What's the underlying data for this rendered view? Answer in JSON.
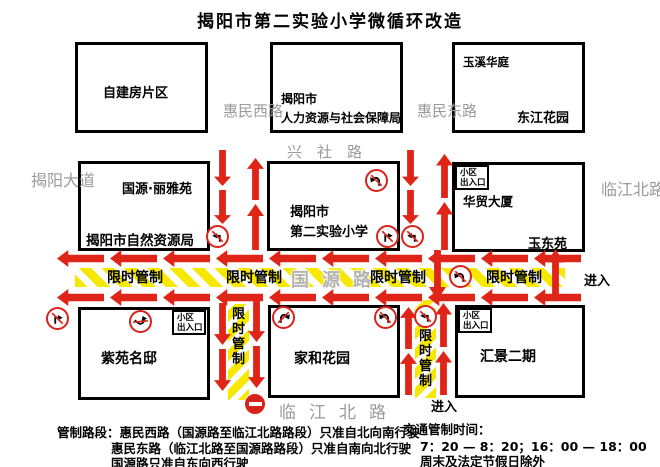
{
  "title": "揭阳市第二实验小学微循环改造",
  "buildings": {
    "zijian": "自建房片区",
    "renshe_l1": "揭阳市",
    "renshe_l2": "人力资源与社会保障局",
    "yuxi": "玉溪华庭",
    "dongjiang": "东江花园",
    "liyayuan": "国源·丽雅苑",
    "ziran": "揭阳市自然资源局",
    "school_l1": "揭阳市",
    "school_l2": "第二实验小学",
    "huamao": "华贸大厦",
    "yudongyuan": "玉东苑",
    "ziyuan": "紫苑名邸",
    "jiahe": "家和花园",
    "huijing": "汇景二期",
    "gate_l1": "小区",
    "gate_l2": "出入口"
  },
  "streets": {
    "jieyang_avenue": "揭阳大道",
    "huimin_west": "惠民西路",
    "huimin_east": "惠民东路",
    "xingshe": "兴社路",
    "guoyuan": "国源路",
    "linjiang_east": "临江北路",
    "linjiang_south": "临江北路"
  },
  "controls": {
    "limited": "限时管制",
    "enter": "进入"
  },
  "notes": {
    "line1": "管制路段：惠民西路（国源路至临江北路路段）只准自北向南行驶",
    "line2": "惠民东路（临江北路至国源路路段）只准自南向北行驶",
    "line3": "国源路只准自东向西行驶"
  },
  "schedule": {
    "heading": "交通管制时间：",
    "times": "7：20 — 8：20；16：00 — 18：00",
    "exception": "周末及法定节假日除外"
  },
  "colors": {
    "arrow_red": "#df2418",
    "control_yellow": "#f6e800",
    "street_gray": "#9a9a9a"
  }
}
